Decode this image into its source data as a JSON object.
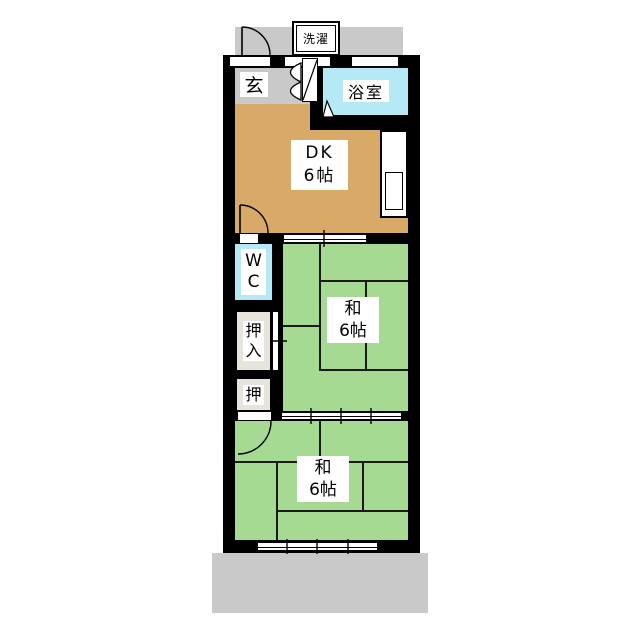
{
  "floor_plan": {
    "rooms": {
      "laundry": {
        "label": "洗濯"
      },
      "entrance": {
        "label": "玄"
      },
      "bathroom": {
        "label": "浴室"
      },
      "dk": {
        "name_line": "DK",
        "size_line": "6帖"
      },
      "wc": {
        "line1": "W",
        "line2": "C"
      },
      "oshiire_closet": {
        "line1": "押",
        "line2": "入"
      },
      "oshi_closet": {
        "label": "押"
      },
      "washitsu_upper": {
        "name_line": "和",
        "size_line": "6帖"
      },
      "washitsu_lower": {
        "name_line": "和",
        "size_line": "6帖"
      }
    },
    "colors": {
      "dk_floor": "#d9a967",
      "tatami_green": "#a6da93",
      "water_area_cyan": "#b5e9f6",
      "corridor_gray": "#c9c9c9",
      "balcony_gray": "#c9c9c9",
      "closet_beige": "#e7e4db",
      "wall_black": "#000000",
      "background_white": "#ffffff"
    }
  }
}
